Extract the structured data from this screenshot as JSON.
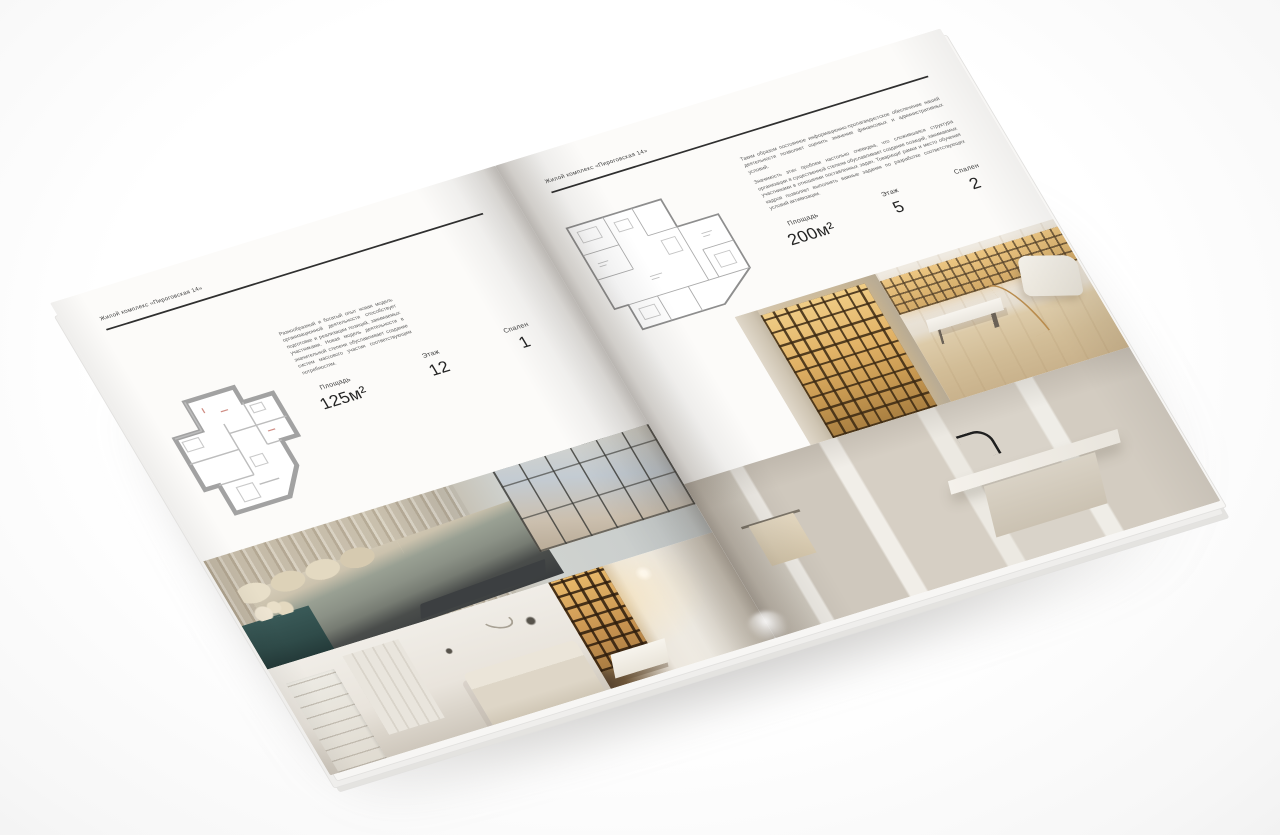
{
  "colors": {
    "page": "#fcfbf9",
    "rule": "#2f2f2f",
    "body_text": "#5d5d5d",
    "stat_value": "#242424",
    "amber_shelves": "#d9a95e",
    "wood_floor": "#d3bd98",
    "teal_dresser": "#2f4b49"
  },
  "magazine": {
    "left_page": {
      "header": "Жилой комплекс «Пироговская 14»",
      "description": "Разнообразный и богатый опыт новая модель организационной деятельности способствует подготовке и реализации позиций, занимаемых участниками. Новая модель деятельности в значительной степени обуславливает создание систем массового участия соответствующим потребностям.",
      "stats": {
        "area_label": "Площадь",
        "area_value": "125м²",
        "floor_label": "Этаж",
        "floor_value": "12",
        "bedrooms_label": "Спален",
        "bedrooms_value": "1"
      }
    },
    "right_page": {
      "header": "Жилой комплекс «Пироговская 14»",
      "description_1": "Таким образом постоянное информационно-пропагандистское обеспечение нашей деятельности позволяет оценить значение финансовых и административных условий.",
      "description_2": "Значимость этих проблем настолько очевидна, что сложившаяся структура организации в существенной степени обуславливает создание позиций, занимаемых участниками в отношении поставленных задач. Товарищи! рамки и место обучения кадров позволяет выполнять важные задания по разработке соответствующих условий активизации.",
      "stats": {
        "area_label": "Площадь",
        "area_value": "200м²",
        "floor_label": "Этаж",
        "floor_value": "5",
        "bedrooms_label": "Спален",
        "bedrooms_value": "2"
      }
    }
  }
}
